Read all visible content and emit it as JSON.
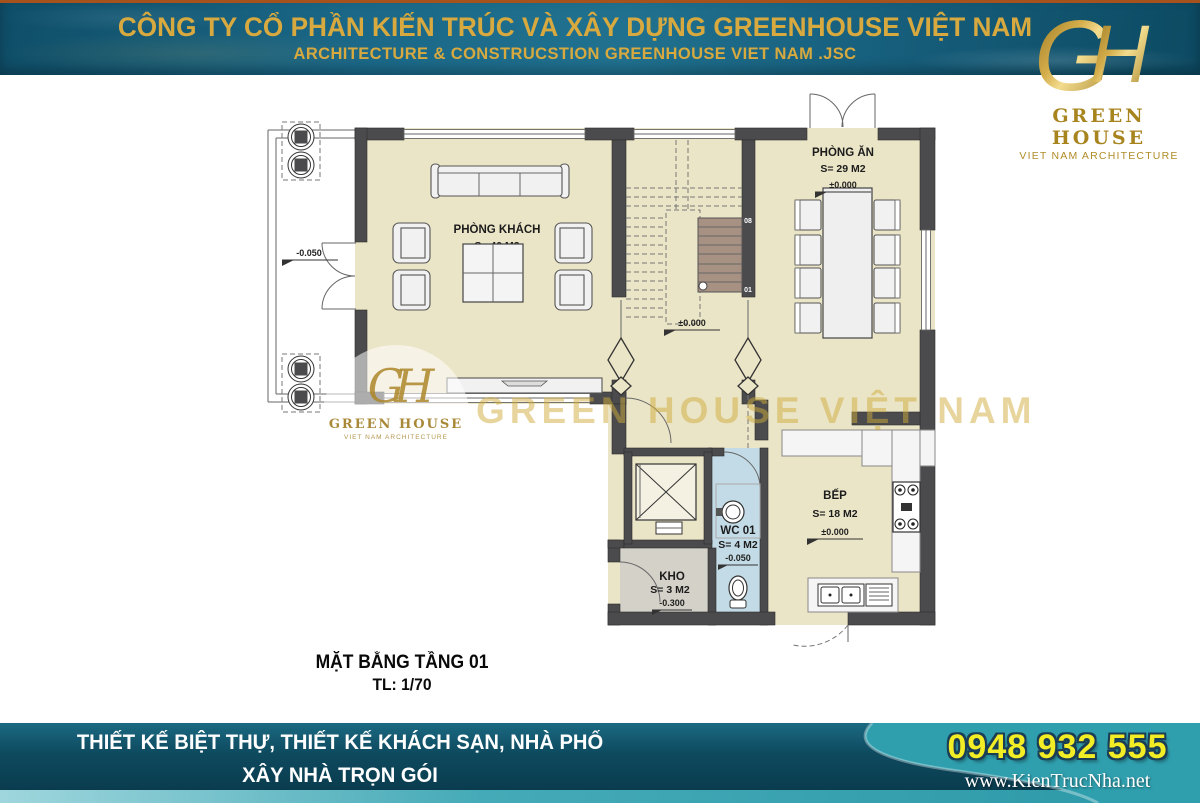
{
  "header": {
    "title": "CÔNG TY CỔ PHẦN KIẾN TRÚC VÀ XÂY DỰNG GREENHOUSE VIỆT NAM",
    "subtitle": "ARCHITECTURE & CONSTRUCSTION GREENHOUSE VIET NAM .JSC"
  },
  "logo": {
    "monogram_g": "G",
    "monogram_h": "H",
    "name": "GREEN HOUSE",
    "tagline": "VIET NAM ARCHITECTURE"
  },
  "plan": {
    "title": "MẶT BẰNG TẦNG 01",
    "scale": "TL: 1/70",
    "rooms": {
      "living": {
        "name": "PHÒNG KHÁCH",
        "area": "S= 40 M2"
      },
      "dining": {
        "name": "PHÒNG ĂN",
        "area": "S= 29 M2",
        "level": "±0.000"
      },
      "kitchen": {
        "name": "BẾP",
        "area": "S= 18 M2",
        "level": "±0.000"
      },
      "wc": {
        "name": "WC 01",
        "area": "S= 4 M2",
        "level": "-0.050"
      },
      "storage": {
        "name": "KHO",
        "area": "S= 3 M2",
        "level": "-0.300"
      }
    },
    "markers": {
      "porch_level": "-0.050",
      "hall_level": "±0.000"
    },
    "stairs": {
      "top_step": "08",
      "bottom_step": "01"
    }
  },
  "watermark": {
    "monogram": "GH",
    "name": "GREEN HOUSE",
    "tagline": "VIET NAM ARCHITECTURE",
    "text": "GREEN HOUSE VIỆT NAM"
  },
  "footer": {
    "line1": "THIẾT KẾ BIỆT THỰ, THIẾT KẾ KHÁCH SẠN, NHÀ PHỐ",
    "line2": "XÂY NHÀ TRỌN GÓI",
    "phone": "0948 932 555",
    "website": "www.KienTrucNha.net"
  },
  "colors": {
    "header_gold": "#d7a93f",
    "band_teal": "#17607e",
    "footer_bright_teal": "#2f9fae",
    "phone_yellow": "#f2ed25",
    "floor_beige": "#ebe5c7",
    "wall_gray": "#4b4b4d",
    "wc_blue": "#c3dbe6",
    "storage_gray": "#d4d1c8",
    "stair_brown": "#a79183"
  }
}
